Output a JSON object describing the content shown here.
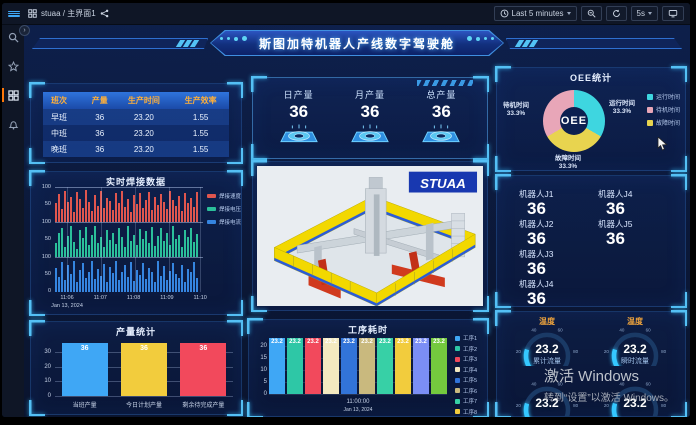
{
  "topbar": {
    "breadcrumb": "stuaa / 主界面1",
    "time_range": "Last 5 minutes",
    "refresh_interval": "5s"
  },
  "banner": {
    "title": "斯图加特机器人产线数字驾驶舱"
  },
  "shift_table": {
    "headers": [
      "班次",
      "产量",
      "生产时间",
      "生产效率"
    ],
    "rows": [
      [
        "早班",
        "36",
        "23.20",
        "1.55"
      ],
      [
        "中班",
        "36",
        "23.20",
        "1.55"
      ],
      [
        "晚班",
        "36",
        "23.20",
        "1.55"
      ]
    ]
  },
  "production_cards": [
    {
      "label": "日产量",
      "value": "36"
    },
    {
      "label": "月产量",
      "value": "36"
    },
    {
      "label": "总产量",
      "value": "36"
    }
  ],
  "robots": [
    {
      "label": "机器人J1",
      "value": "36"
    },
    {
      "label": "机器人J4",
      "value": "36"
    },
    {
      "label": "机器人J2",
      "value": "36"
    },
    {
      "label": "机器人J5",
      "value": "36"
    },
    {
      "label": "机器人J3",
      "value": "36"
    },
    {
      "label": "",
      "value": ""
    },
    {
      "label": "机器人J4",
      "value": "36"
    },
    {
      "label": "",
      "value": ""
    }
  ],
  "machine": {
    "logo": "STUAA"
  },
  "watermark": {
    "line1": "激活 Windows",
    "line2": "转到“设置”以激活 Windows。"
  },
  "chart_data": [
    {
      "id": "oee",
      "type": "pie",
      "title": "OEE统计",
      "center_label": "OEE",
      "slices": [
        {
          "label": "运行时间",
          "pct": "33.3%",
          "value": 33.3,
          "color": "#3ed6e0",
          "pos": "right"
        },
        {
          "label": "待机时间",
          "pct": "33.3%",
          "value": 33.3,
          "color": "#e8a6b8",
          "pos": "left"
        },
        {
          "label": "故障时间",
          "pct": "33.3%",
          "value": 33.3,
          "color": "#e8d44f",
          "pos": "bottom"
        }
      ],
      "legend_position": "right"
    },
    {
      "id": "welding",
      "type": "bar",
      "title": "实时焊接数据",
      "x_ticks": [
        "11:06",
        "11:07",
        "11:08",
        "11:09",
        "11:10"
      ],
      "x_date": "Jan 13, 2024",
      "band_y_ticks": [
        "100",
        "50",
        "0"
      ],
      "ylim": [
        0,
        100
      ],
      "series": [
        {
          "name": "焊接速度",
          "color": "#e0564e",
          "values": [
            55,
            82,
            38,
            90,
            60,
            75,
            28,
            88,
            68,
            42,
            95,
            58,
            33,
            80,
            48,
            92,
            40,
            72,
            62,
            35,
            85,
            55,
            90,
            45,
            68,
            30,
            78,
            52,
            86,
            42,
            65,
            88,
            34,
            74,
            50,
            82,
            58,
            38,
            92,
            64,
            46,
            76,
            32,
            84,
            56,
            70,
            44,
            88
          ]
        },
        {
          "name": "焊接电压",
          "color": "#2bbf9a",
          "values": [
            40,
            70,
            85,
            30,
            62,
            90,
            45,
            25,
            78,
            55,
            88,
            35,
            65,
            92,
            42,
            58,
            30,
            80,
            50,
            72,
            38,
            85,
            60,
            28,
            90,
            48,
            66,
            34,
            82,
            54,
            76,
            40,
            88,
            32,
            62,
            84,
            46,
            70,
            36,
            90,
            52,
            64,
            28,
            78,
            58,
            86,
            44,
            68
          ]
        },
        {
          "name": "焊接电流",
          "color": "#3585e0",
          "values": [
            70,
            45,
            88,
            35,
            78,
            52,
            90,
            30,
            64,
            86,
            40,
            58,
            92,
            38,
            68,
            48,
            82,
            28,
            74,
            56,
            90,
            36,
            60,
            80,
            44,
            88,
            32,
            66,
            50,
            84,
            38,
            72,
            58,
            28,
            90,
            46,
            76,
            34,
            62,
            86,
            52,
            40,
            80,
            30,
            68,
            58,
            88,
            42
          ]
        }
      ]
    },
    {
      "id": "production",
      "type": "bar",
      "title": "产量统计",
      "categories": [
        "当班产量",
        "今日计划产量",
        "剩余待完成产量"
      ],
      "values": [
        36,
        36,
        36
      ],
      "colors": [
        "#3fa7f5",
        "#f2cc3d",
        "#f2495c"
      ],
      "y_ticks": [
        0,
        10,
        20,
        30
      ],
      "ylim": [
        0,
        38
      ]
    },
    {
      "id": "process",
      "type": "bar",
      "title": "工序耗时",
      "values": [
        23.2,
        23.2,
        23.2,
        23.2,
        23.2,
        23.2,
        23.2,
        23.2,
        23.2,
        23.2
      ],
      "value_label": "23.2",
      "colors": [
        "#3fa7f5",
        "#2ec7a6",
        "#f2495c",
        "#f3e9c0",
        "#3274d9",
        "#c9b97e",
        "#37d0a6",
        "#f2cc3d",
        "#7b8ef5",
        "#74c93e"
      ],
      "legend": [
        "工序1",
        "工序2",
        "工序3",
        "工序4",
        "工序5",
        "工序6",
        "工序7",
        "工序8",
        "工序9",
        "工序10"
      ],
      "y_ticks": [
        0,
        5,
        10,
        15,
        20
      ],
      "ylim": [
        0,
        24
      ],
      "x_tick": "11:00:00",
      "x_date": "Jan 13, 2024"
    },
    {
      "id": "gauges",
      "type": "gauge",
      "min": 0,
      "max": 100,
      "ticks": [
        0,
        20,
        40,
        60,
        80,
        100
      ],
      "color": "#35c8ff",
      "items": [
        {
          "title": "温度",
          "value": "23.2",
          "sublabel": "累计流量"
        },
        {
          "title": "温度",
          "value": "23.2",
          "sublabel": "瞬时流量"
        },
        {
          "title": "",
          "value": "23.2",
          "sublabel": ""
        },
        {
          "title": "",
          "value": "23.2",
          "sublabel": ""
        }
      ]
    }
  ]
}
